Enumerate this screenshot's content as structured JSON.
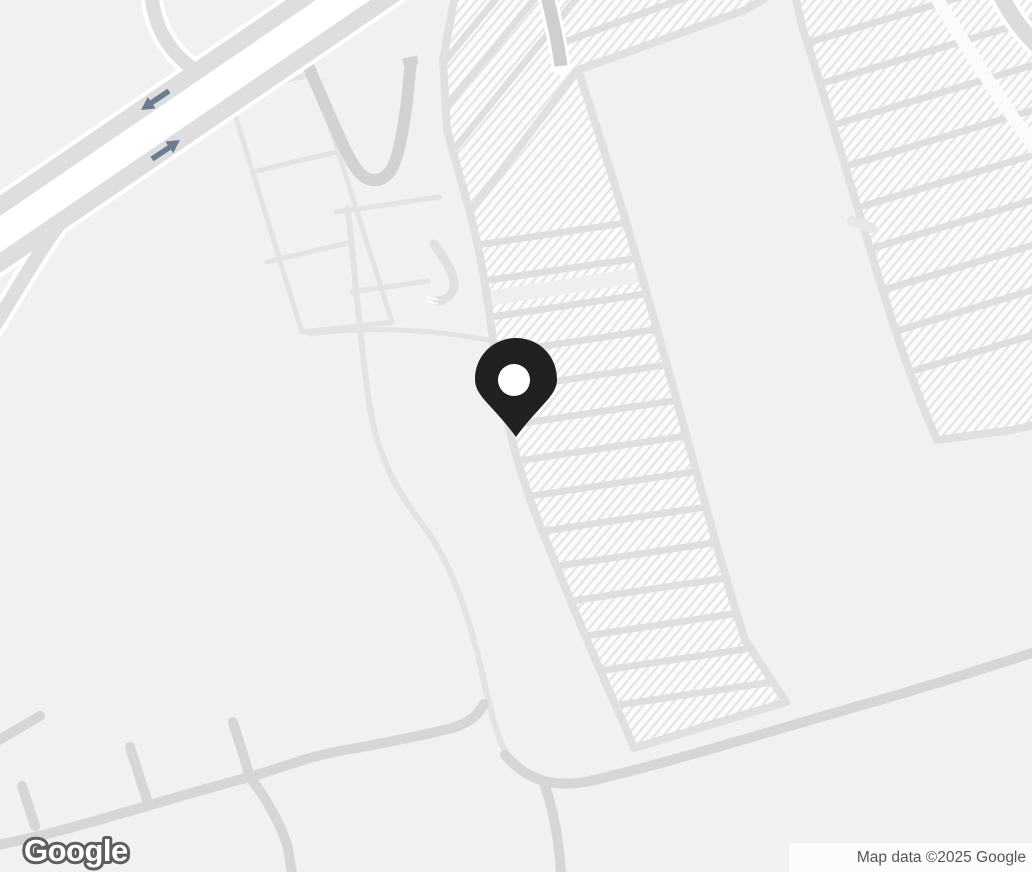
{
  "window": {
    "width": 1032,
    "height": 872
  },
  "branding": {
    "logo_text": "Google"
  },
  "attribution": {
    "text": "Map data ©2025 Google"
  },
  "marker": {
    "type": "location-pin",
    "color": "#212121",
    "hole_color": "#ffffff",
    "tip_x": 516,
    "tip_y": 437
  },
  "colors": {
    "background": "#f1f1f1",
    "parking_lot_fill": "#fdfdfd",
    "parking_hatch_stripe": "#e6e6e6",
    "aisle_road": "#dfdfdf",
    "local_road": "#d6d6d6",
    "loop_road": "#d2d2d2",
    "highway_road": "#dedede",
    "entrance_road": "#cfcfcf",
    "road_casing": "#ffffff",
    "one_way_arrow": "#6b7c90",
    "attribution_text": "#565656",
    "logo_fill": "#ffffff",
    "logo_outline": "#5e5e5e"
  }
}
